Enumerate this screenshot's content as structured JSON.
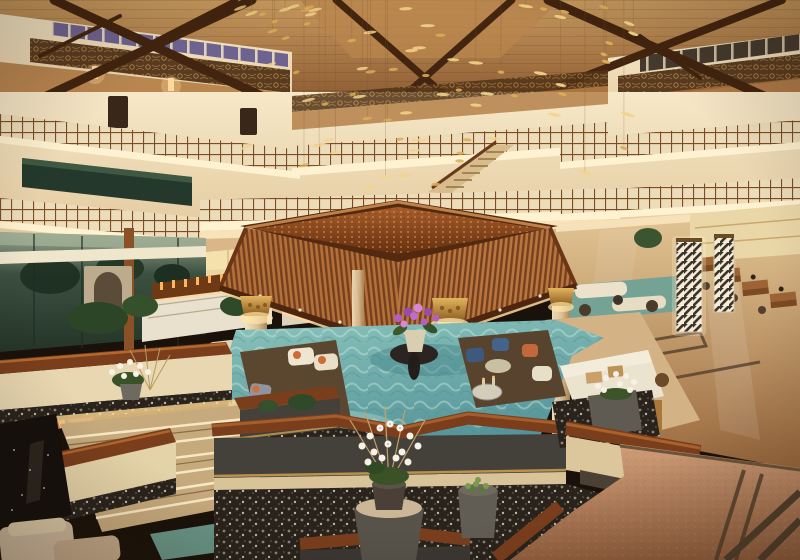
{
  "scene": {
    "description": "Warmly lit multi-storey resort hotel atrium lobby: timber truss roof with clerestory windows, carved friezes and lattice-railed balconies, a golden hanging-leaf chandelier, a square slatted pavilion canopy on cream columns above a turquoise reflecting pond with lounge seating, terraced dark planters with white orchids, stone steps, a bar, reception desks and polished marble floors",
    "kind": "photograph",
    "elements": [
      "timber-roof-trusses",
      "clerestory-windows",
      "carved-wood-frieze",
      "wall-sconces",
      "balcony-lattice-railings",
      "cove-lighting",
      "grand-staircase",
      "hanging-gold-leaf-chandelier",
      "pavilion-canopy",
      "gilded-column-capitals",
      "reflecting-pond",
      "lounge-armchairs",
      "white-sofa",
      "purple-orchid-centerpiece",
      "white-orchid-planters",
      "stone-steps",
      "pebble-beds",
      "bar-counter",
      "illuminated-lattice-pillars",
      "reception-desks",
      "marble-floor-inlay",
      "glass-wall-garden-view"
    ]
  },
  "structure": {
    "balcony_levels": 3,
    "canopy_columns": 3,
    "clerestory_windows_left": 10,
    "clerestory_windows_right": 7,
    "reception_desks": 4
  },
  "installation": {
    "name": "hanging-gold-leaf-chandelier",
    "leaf_count": 74,
    "string_every": 3,
    "leaf_colors": [
      "#f3d488",
      "#dcae57"
    ],
    "string_color": "rgba(120,82,48,0.30)"
  },
  "palette": {
    "roof-wood": "#9b6a3b",
    "truss-dark": "#42240f",
    "wall-cream": "#f2e2bf",
    "wall-shadow": "#dfc398",
    "frieze-brown": "#503318",
    "window-violet": "#6e6390",
    "window-night": "#453a2e",
    "lattice-wood": "#7c4c24",
    "cove-light": "#fff2d0",
    "glass-dusk": "#31443a",
    "canopy-wood": "#a86331",
    "canopy-rim": "#53290f",
    "column-cream": "#eddcba",
    "capital-gold": "#d9a84e",
    "pond-teal": "#5f9fa3",
    "island-wood": "#5b4730",
    "sofa-cream": "#ece3cf",
    "accent-orange": "#cf6b35",
    "accent-blue": "#3d5a7e",
    "cap-mahogany": "#7a3e1c",
    "planter-grey": "#44403a",
    "pebble-dark": "#29231c",
    "granite-salmon": "#b97f58",
    "marble-floor": "#c69d6d",
    "orchid-white": "#f7f2e6",
    "orchid-purple": "#b45fc0",
    "foliage-green": "#35512c",
    "glow-amber": "#ffd894",
    "rug-teal": "#74a295",
    "brass": "#b5823f",
    "pool-black": "#14100d"
  }
}
